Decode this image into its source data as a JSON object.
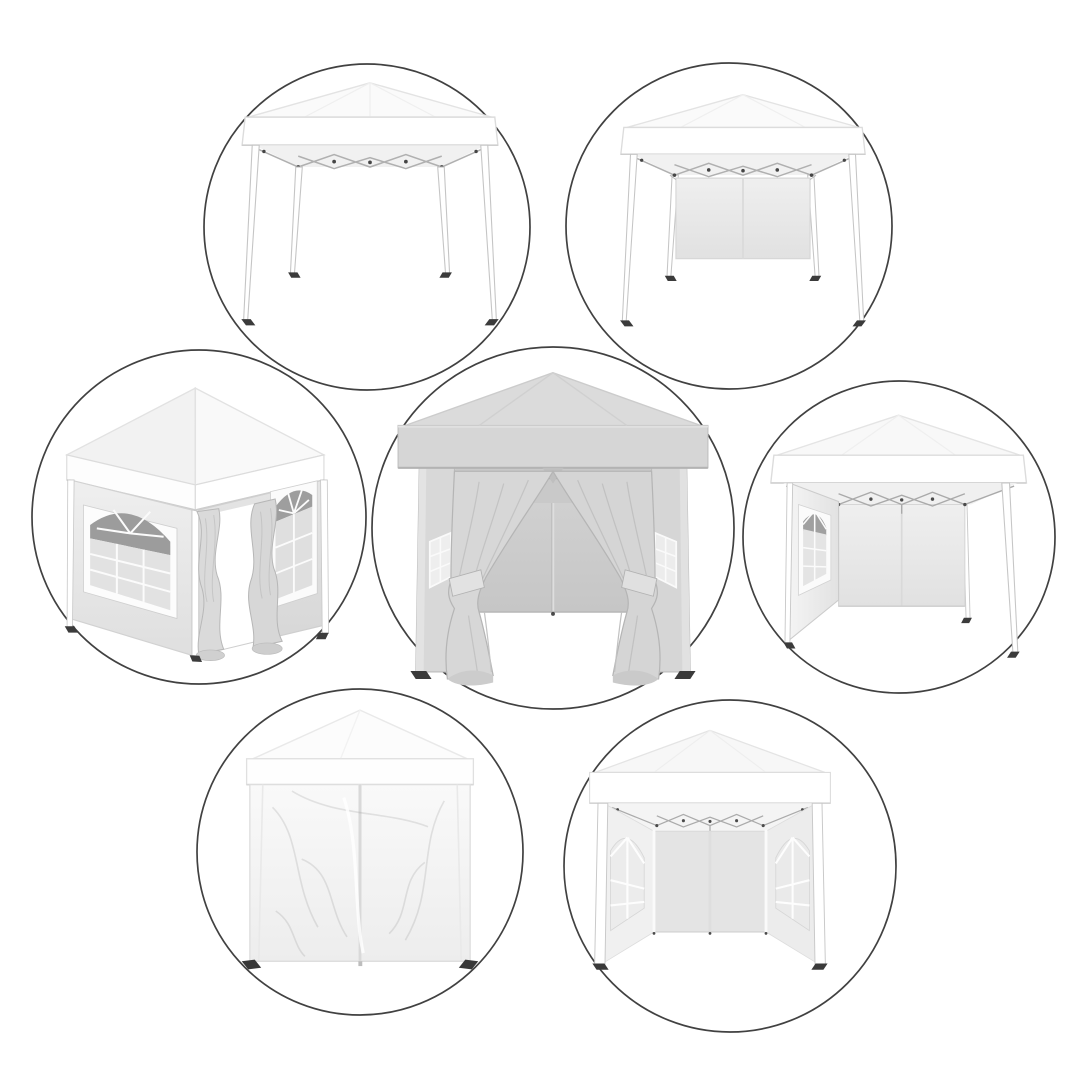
{
  "page": {
    "kind": "product-image-collage",
    "background_color": "#ffffff",
    "text_visible": false
  },
  "collage": {
    "title": "Pop-up gazebo canopy tent - seven configuration views in circular vignettes",
    "vignette_count": 7,
    "style": {
      "circle_stroke_color": "#414141",
      "tent_white": "#ffffff",
      "roof_shade": "#f7f7f7",
      "gray_variant_roof": "#dbdbdb",
      "wall_light_gray": "#ececec",
      "interior_wall_gray": "#c9c9c9",
      "curtain_gray": "#d7d7d7",
      "window_arch_dark": "#9c9c9c",
      "frame_truss_gray": "#ababab",
      "foot_dark": "#3a3a3a"
    },
    "vignettes": [
      {
        "id": "frame-only",
        "position": "top-left",
        "title": "Pop-up canopy frame with white top only, no sidewalls"
      },
      {
        "id": "one-back-wall",
        "position": "top-right",
        "title": "White canopy with single plain back sidewall hung between rear legs"
      },
      {
        "id": "windows-and-curtains-angled",
        "position": "middle-left",
        "title": "Angled view of gazebo with arched church windows and open curtain doorway"
      },
      {
        "id": "curtains-tied-open-front",
        "position": "center",
        "title": "Gray gazebo front view with doorway curtains swept and tied open showing interior"
      },
      {
        "id": "window-sidewall-back-wall",
        "position": "middle-right",
        "title": "Canopy with arched-window side panel and plain back wall, front open"
      },
      {
        "id": "fully-closed",
        "position": "bottom-left",
        "title": "Gazebo fully closed with zipped wrinkled sidewalls on all sides"
      },
      {
        "id": "two-window-sidewalls-open-front",
        "position": "bottom-right",
        "title": "Open-front gazebo interior with two arched-window sidewalls and back wall"
      }
    ]
  }
}
